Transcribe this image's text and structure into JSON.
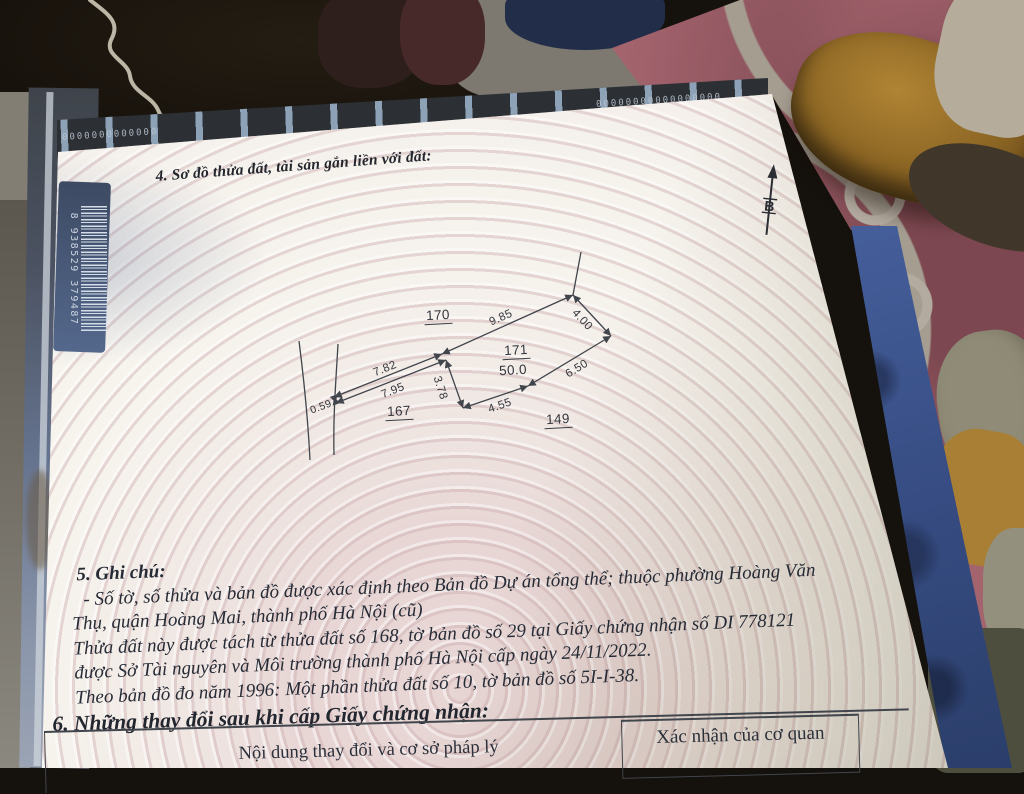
{
  "certificate": {
    "section4_heading": "4. Sơ đồ thửa đất, tài sản gắn liền với đất:",
    "north_label": "B",
    "diagram": {
      "parcel_170": "170",
      "parcel_171": "171",
      "parcel_171_area": "50.0",
      "parcel_167": "167",
      "parcel_149": "149",
      "dim_9_85": "9.85",
      "dim_4_00": "4.00",
      "dim_6_50": "6.50",
      "dim_4_55": "4.55",
      "dim_3_78": "3.78",
      "dim_7_95": "7.95",
      "dim_7_82": "7.82",
      "dim_0_59": "0.59"
    },
    "section5_heading": "5. Ghi chú:",
    "notes": [
      "- Số tờ, số thửa và bản đồ được xác định theo Bản đồ Dự án tổng thể; thuộc phường Hoàng Văn",
      "Thụ, quận Hoàng Mai, thành phố Hà Nội (cũ)",
      "Thửa đất này được tách từ thửa đất số 168, tờ bản đồ số 29 tại Giấy chứng nhận số DI 778121",
      "được Sở Tài nguyên và Môi trường thành phố Hà Nội cấp ngày 24/11/2022.",
      "Theo bản đồ đo năm 1996: Một phần thửa đất số 10, tờ bản đồ số 5I-I-38."
    ],
    "section6_heading": "6. Những thay đổi sau khi cấp Giấy chứng nhận:",
    "table": {
      "left_header": "Nội dung thay đổi và cơ sở pháp lý",
      "right_header": "Xác nhận của cơ quan"
    },
    "barcode_number": "8 938529 379487",
    "edge_zeros_left": "0000000000000",
    "edge_zeros_right": "00000000000000000"
  },
  "colors": {
    "page": "#f7f4ee",
    "guilloche_pink": "#d8c0c2",
    "rug": "#a4646e",
    "table_blue": "#44619e",
    "ink": "#2a2e38"
  }
}
